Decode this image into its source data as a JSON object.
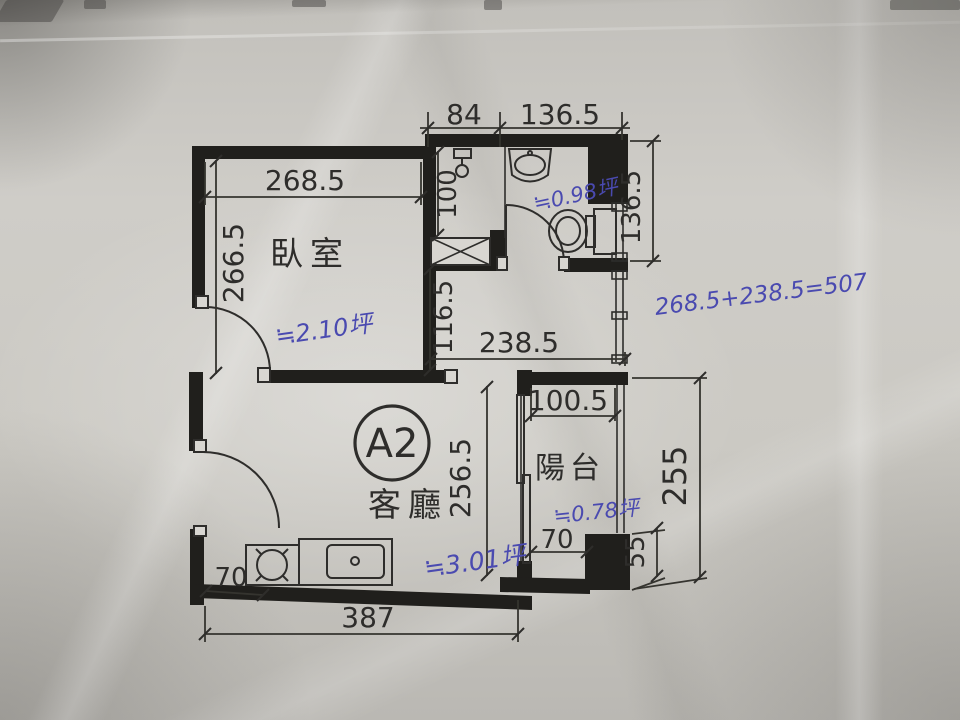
{
  "unit": {
    "label": "A2"
  },
  "rooms": {
    "bedroom": {
      "label": "臥室",
      "area_note": "≒2.10坪"
    },
    "living_room": {
      "label": "客廳",
      "area_note": "≒3.01坪"
    },
    "balcony": {
      "label": "陽台",
      "area_note": "≒0.78坪"
    },
    "bathroom": {
      "area_note": "≒0.98坪"
    }
  },
  "dimensions_cm": {
    "shaft_top_width": "84",
    "bathroom_top_width": "136.5",
    "bedroom_width": "268.5",
    "bedroom_height": "266.5",
    "shaft_height": "100",
    "bathroom_right_height": "136.5",
    "hallway_height": "116.5",
    "hallway_width": "238.5",
    "balcony_top_width": "100.5",
    "living_room_height": "256.5",
    "balcony_right_height": "255",
    "balcony_bottom_width": "70",
    "balcony_ledge_height": "55",
    "kitchen_left_offset": "70",
    "living_room_width": "387"
  },
  "handwriting": {
    "sum_equation": "268.5+238.5=507",
    "ink_color": "#4a4ab0"
  },
  "colors": {
    "paper": "#cac8c2",
    "line": "#2e2d2b",
    "wall": "#201f1c",
    "ink": "#4a4ab0"
  }
}
